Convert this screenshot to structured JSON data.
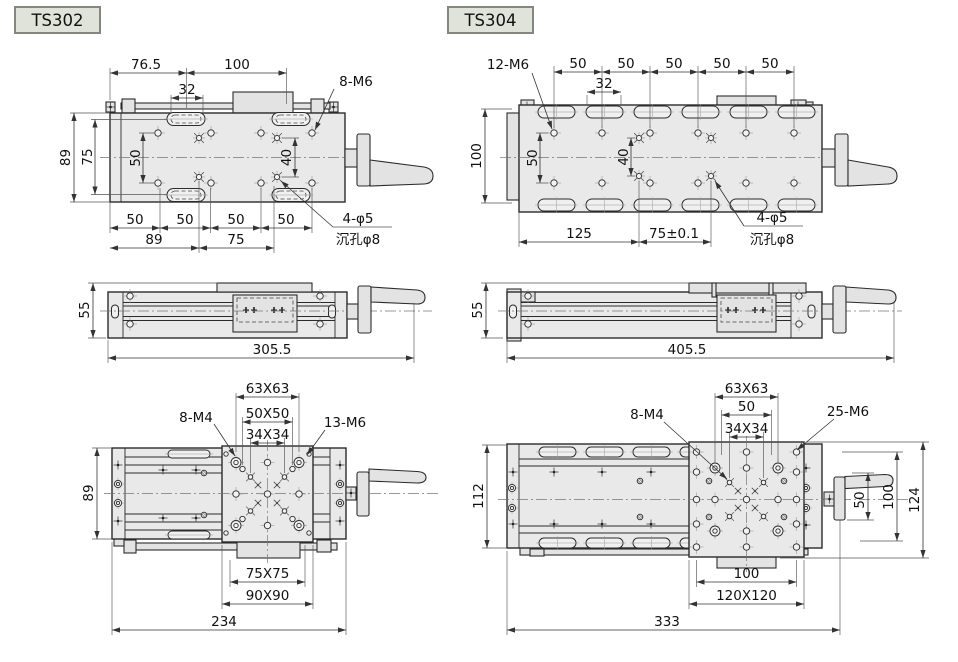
{
  "page": {
    "background": "#ffffff"
  },
  "ts302": {
    "label": "TS302",
    "top_view": {
      "w_left": "76.5",
      "w_right": "100",
      "slot": "32",
      "thread": "8-M6",
      "h_outer": "89",
      "h_inner": "75",
      "row": "50",
      "pair": "40",
      "segs": [
        "50",
        "50",
        "50",
        "50"
      ],
      "span_left": "89",
      "span_right": "75",
      "cb1": "4-φ5",
      "cb2": "沉孔φ8"
    },
    "side_view": {
      "h": "55",
      "len": "305.5"
    },
    "bottom_view": {
      "d63": "63X63",
      "d50": "50X50",
      "d34": "34X34",
      "m4": "8-M4",
      "m6": "13-M6",
      "h": "89",
      "b1": "75X75",
      "b2": "90X90",
      "total": "234"
    }
  },
  "ts304": {
    "label": "TS304",
    "top_view": {
      "thread": "12-M6",
      "segs": [
        "50",
        "50",
        "50",
        "50",
        "50"
      ],
      "slot": "32",
      "h_outer": "100",
      "row": "50",
      "pair": "40",
      "span_left": "125",
      "span_right": "75±0.1",
      "cb1": "4-φ5",
      "cb2": "沉孔φ8"
    },
    "side_view": {
      "h": "55",
      "len": "405.5"
    },
    "bottom_view": {
      "d63": "63X63",
      "d50": "50",
      "d34": "34X34",
      "m4": "8-M4",
      "m6": "25-M6",
      "h": "112",
      "r50": "50",
      "r100": "100",
      "r124": "124",
      "b1": "100",
      "b2": "120X120",
      "total": "333"
    }
  }
}
